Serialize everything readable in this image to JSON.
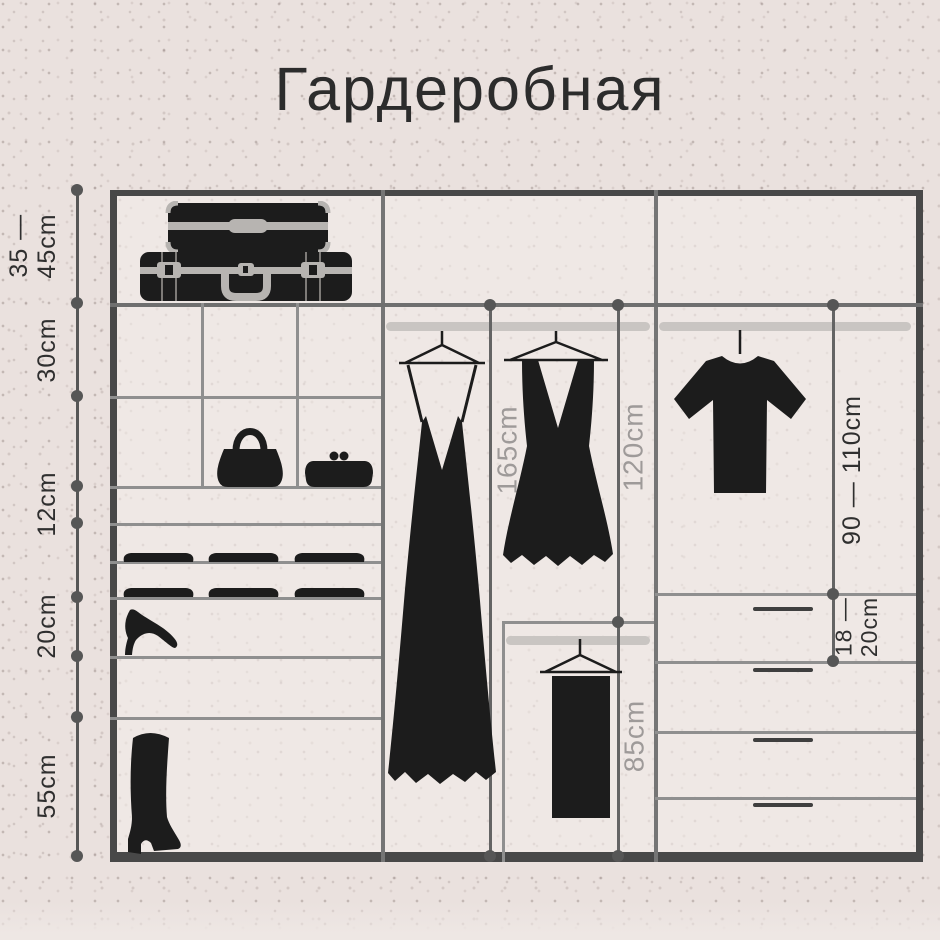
{
  "title": "Гардеробная",
  "colors": {
    "bg": "#eae1de",
    "panel": "#efe8e5",
    "frame": "#484848",
    "line": "#8f8f8f",
    "rod": "#c9c5c2",
    "ink": "#1c1c1c",
    "dot": "#565656",
    "label_dark": "#2f2f2f",
    "label_gray": "#9e9a99"
  },
  "rail": {
    "labels": [
      {
        "line1": "35 —",
        "line2": "45cm"
      },
      {
        "line1": "30cm"
      },
      {
        "line1": "12cm"
      },
      {
        "line1": "20cm"
      },
      {
        "line1": "55cm"
      }
    ]
  },
  "measurements": {
    "long_hang": "165cm",
    "mid_hang": "120cm",
    "short_hang": "85cm",
    "right_hang": "90 — 110cm",
    "drawer": {
      "line1": "18 —",
      "line2": "20cm"
    }
  },
  "icons": [
    "suitcases-icon",
    "handbag-icon",
    "clutch-icon",
    "folded-clothes-icon",
    "high-heel-icon",
    "boot-icon",
    "long-dress-icon",
    "short-dress-icon",
    "tshirt-icon",
    "trousers-icon",
    "hanger-icon",
    "clothes-rod"
  ]
}
